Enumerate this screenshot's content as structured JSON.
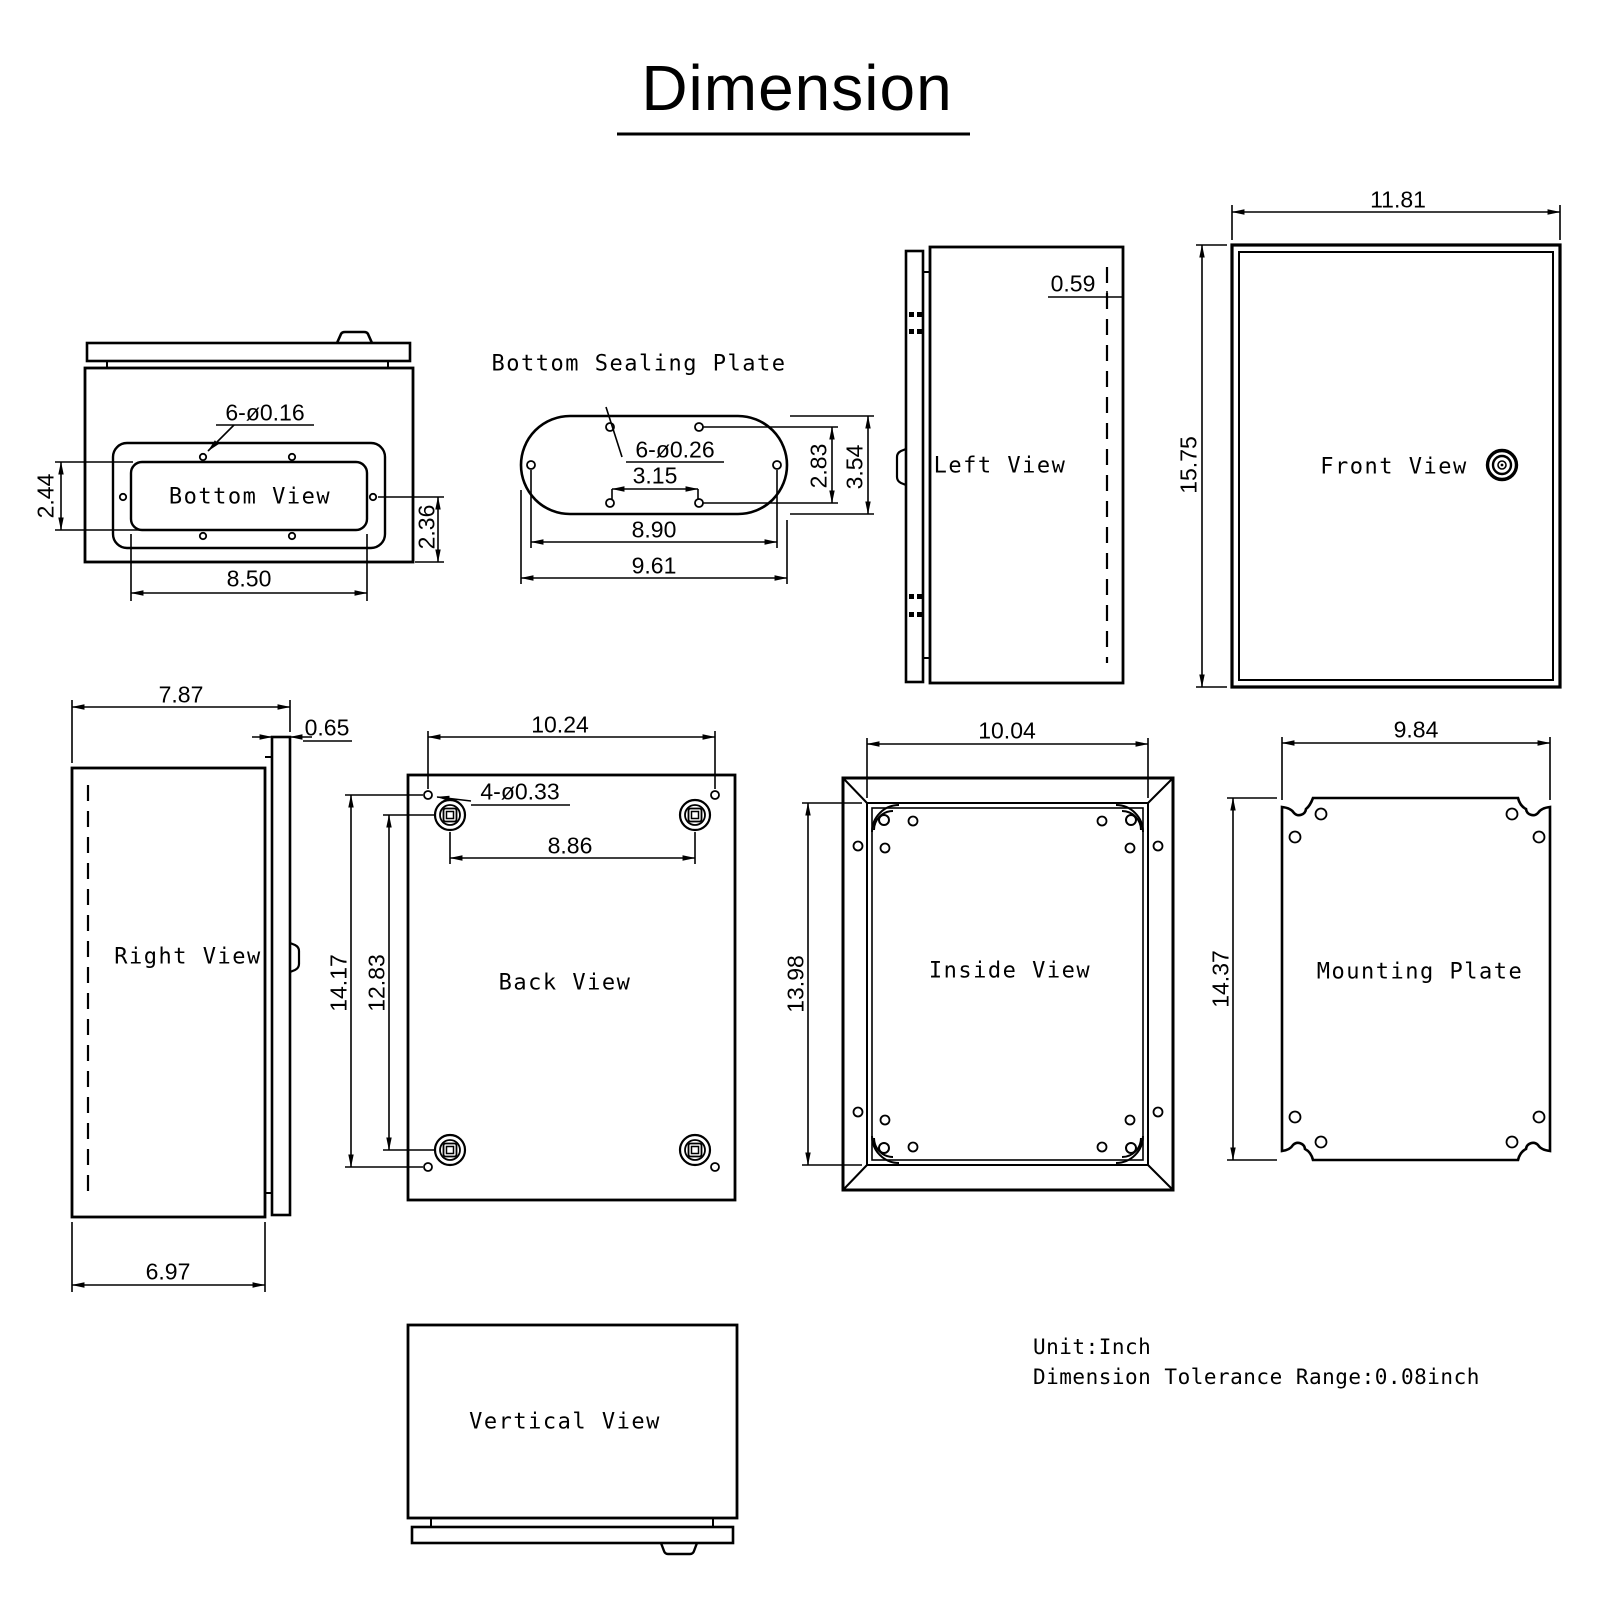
{
  "title": "Dimension",
  "views": {
    "bottom_view": {
      "label": "Bottom View",
      "dims": {
        "holes": "6-ø0.16",
        "left_height": "2.44",
        "right_height": "2.36",
        "width": "8.50"
      }
    },
    "bottom_sealing_plate": {
      "label": "Bottom Sealing Plate",
      "dims": {
        "holes": "6-ø0.26",
        "inner_width": "3.15",
        "hole_height": "2.83",
        "plate_height": "3.54",
        "hole_width": "8.90",
        "plate_width": "9.61"
      }
    },
    "left_view": {
      "label": "Left View",
      "dims": {
        "door_inset": "0.59"
      }
    },
    "front_view": {
      "label": "Front View",
      "dims": {
        "width": "11.81",
        "height": "15.75"
      }
    },
    "right_view": {
      "label": "Right View",
      "dims": {
        "total_depth": "7.87",
        "door_depth": "0.65",
        "body_depth": "6.97"
      }
    },
    "back_view": {
      "label": "Back View",
      "dims": {
        "hole_span_width": "10.24",
        "holes": "4-ø0.33",
        "bracket_span_width": "8.86",
        "hole_span_height": "14.17",
        "bracket_span_height": "12.83"
      }
    },
    "inside_view": {
      "label": "Inside View",
      "dims": {
        "width": "10.04",
        "height": "13.98"
      }
    },
    "mounting_plate": {
      "label": "Mounting Plate",
      "dims": {
        "width": "9.84",
        "height": "14.37"
      }
    },
    "vertical_view": {
      "label": "Vertical View"
    }
  },
  "notes": {
    "unit": "Unit:Inch",
    "tolerance": "Dimension Tolerance Range:0.08inch"
  },
  "colors": {
    "line": "#000000",
    "background": "#ffffff"
  }
}
